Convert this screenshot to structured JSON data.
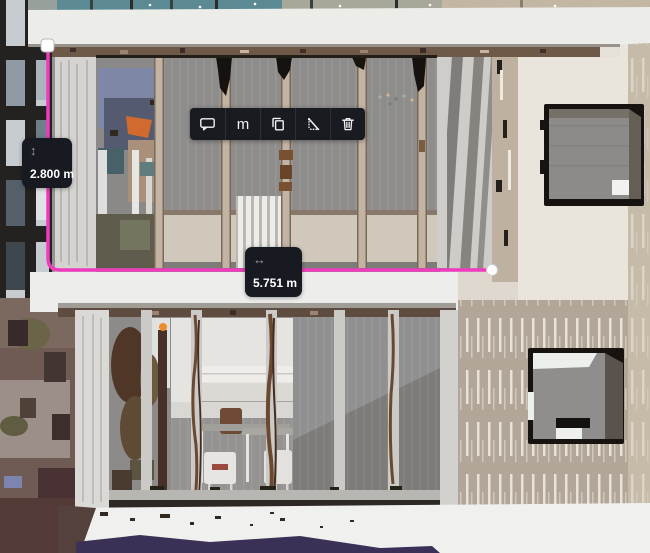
{
  "toolbar": {
    "items": [
      {
        "id": "comment",
        "icon": "comment-icon"
      },
      {
        "id": "unit-meters",
        "label": "m"
      },
      {
        "id": "copy-measurement",
        "icon": "copy-icon"
      },
      {
        "id": "diagonal-measurement",
        "icon": "diagonal-measure-icon"
      },
      {
        "id": "delete-measurement",
        "icon": "trash-icon"
      }
    ]
  },
  "measurements": {
    "vertical": {
      "value": "2.800 m",
      "glyph": "↕"
    },
    "horizontal": {
      "value": "5.751 m",
      "glyph": "↔"
    },
    "line_color": "#ee3cbd"
  },
  "colors": {
    "accent_pink": "#ee3cbd",
    "toolbar_bg": "#191b21",
    "label_bg": "#171a20",
    "handle": "#ffffff"
  }
}
